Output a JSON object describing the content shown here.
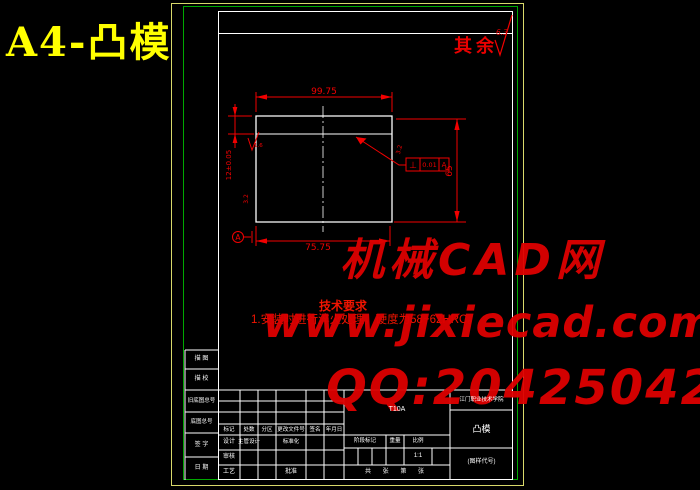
{
  "page": {
    "title": "A4-凸模"
  },
  "corner_note": {
    "label": "其余",
    "roughness": "6.3"
  },
  "drawing": {
    "dim_width_top": "99.75",
    "dim_width_bottom": "75.75",
    "dim_height": "65",
    "dim_step": "12±0.05",
    "rough_step": "1.6",
    "rough_left": "3.2",
    "rough_right": "3.2",
    "fcf": {
      "symbol": "⊥",
      "value": "0.01",
      "datum": "A"
    },
    "datum_label": "A"
  },
  "tech_req": {
    "title": "技术要求",
    "line1": "1.安装时进行淬火处理，硬度为58~62HRC。"
  },
  "watermark": {
    "line1": "机械CAD网",
    "line2": "www.jixiecad.com",
    "line3": "QQ:20425042"
  },
  "titleblock": {
    "margin_rows": [
      "描 图",
      "描 校",
      "旧底图总号",
      "底图总号",
      "签 字",
      "日 期"
    ],
    "header_cols": [
      "标记",
      "处数",
      "分区",
      "更改文件号",
      "签名",
      "年月日"
    ],
    "design_label": "设计",
    "chief_design_label": "主管设计",
    "standardization_label": "标准化",
    "audit_label": "审核",
    "process_label": "工艺",
    "approve_label": "批准",
    "material": "T10A",
    "stage_label": "阶段标记",
    "weight_label": "重量",
    "scale_label": "比例",
    "scale_value": "1:1",
    "sheet_note": "共 张 第 张",
    "unit_name": "江门职业技术学院",
    "part_name": "凸模",
    "drawing_code": "(图样代号)"
  },
  "colors": {
    "border_yellow": "#d9d96a",
    "border_green": "#00a800",
    "line_white": "#ffffff",
    "cad_red": "#f20000",
    "title_yellow": "#ffff00",
    "watermark_red": "#de0000"
  }
}
